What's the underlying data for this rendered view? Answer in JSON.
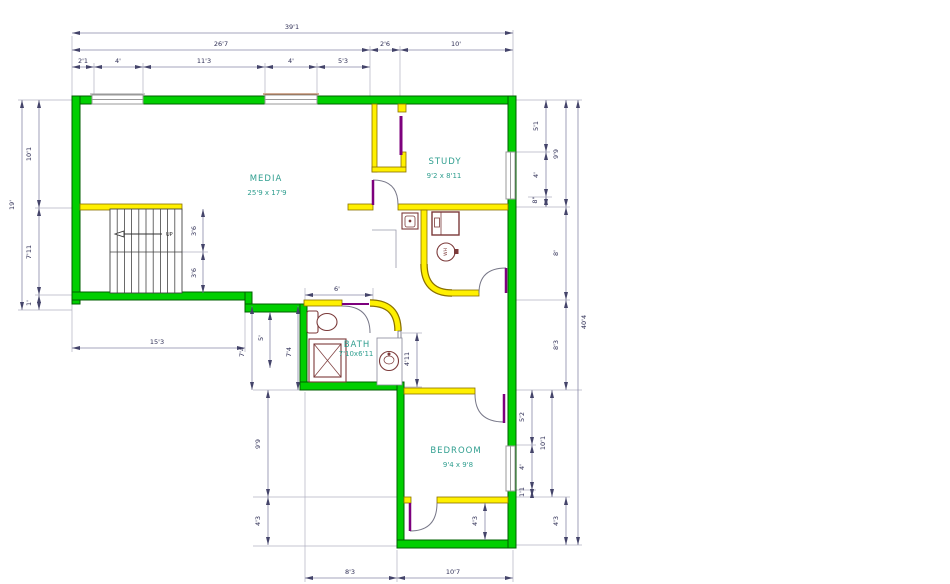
{
  "plan": {
    "type": "floor-plan",
    "stairs": {
      "up_label": "UP"
    },
    "fixtures": {
      "water_heater_label": "WH"
    },
    "colors": {
      "exterior_wall": "#00cf00",
      "interior_wall": "#fff000",
      "door": "#7d007d",
      "fixture_outline": "#7c3a3a",
      "room_text": "#2f9e8f",
      "dimension_text": "#2e2e55",
      "dimension_line": "#8888a8"
    }
  },
  "rooms": [
    {
      "name": "MEDIA",
      "size": "25'9 x 17'9",
      "nx": 266,
      "ny": 181,
      "sx": 267,
      "sy": 195
    },
    {
      "name": "STUDY",
      "size": "9'2 x 8'11",
      "nx": 445,
      "ny": 164,
      "sx": 444,
      "sy": 178
    },
    {
      "name": "BATH",
      "size": "7'10x6'11",
      "nx": 357,
      "ny": 347,
      "sx": 356,
      "sy": 356
    },
    {
      "name": "BEDROOM",
      "size": "9'4 x 9'8",
      "nx": 456,
      "ny": 453,
      "sx": 458,
      "sy": 467
    }
  ],
  "dimensions": [
    {
      "t": "39'1",
      "x1": 72,
      "y1": 33,
      "x2": 513,
      "y2": 33,
      "lx": 292,
      "ly": 29,
      "rot": 0
    },
    {
      "t": "26'7",
      "x1": 72,
      "y1": 50,
      "x2": 370,
      "y2": 50,
      "lx": 221,
      "ly": 46,
      "rot": 0
    },
    {
      "t": "2'6",
      "x1": 370,
      "y1": 50,
      "x2": 400,
      "y2": 50,
      "lx": 385,
      "ly": 46,
      "rot": 0
    },
    {
      "t": "10'",
      "x1": 400,
      "y1": 50,
      "x2": 513,
      "y2": 50,
      "lx": 456,
      "ly": 46,
      "rot": 0
    },
    {
      "t": "2'1",
      "x1": 72,
      "y1": 67,
      "x2": 94,
      "y2": 67,
      "lx": 83,
      "ly": 63,
      "rot": 0
    },
    {
      "t": "4'",
      "x1": 94,
      "y1": 67,
      "x2": 143,
      "y2": 67,
      "lx": 118,
      "ly": 63,
      "rot": 0
    },
    {
      "t": "11'3",
      "x1": 143,
      "y1": 67,
      "x2": 265,
      "y2": 67,
      "lx": 204,
      "ly": 63,
      "rot": 0
    },
    {
      "t": "4'",
      "x1": 265,
      "y1": 67,
      "x2": 317,
      "y2": 67,
      "lx": 291,
      "ly": 63,
      "rot": 0
    },
    {
      "t": "5'3",
      "x1": 317,
      "y1": 67,
      "x2": 370,
      "y2": 67,
      "lx": 343,
      "ly": 63,
      "rot": 0
    },
    {
      "t": "19'",
      "x1": 22,
      "y1": 100,
      "x2": 22,
      "y2": 310,
      "lx": 14,
      "ly": 205,
      "rot": -90
    },
    {
      "t": "10'1",
      "x1": 39,
      "y1": 100,
      "x2": 39,
      "y2": 208,
      "lx": 31,
      "ly": 154,
      "rot": -90
    },
    {
      "t": "7'11",
      "x1": 39,
      "y1": 208,
      "x2": 39,
      "y2": 295,
      "lx": 31,
      "ly": 252,
      "rot": -90
    },
    {
      "t": "1'",
      "x1": 39,
      "y1": 295,
      "x2": 39,
      "y2": 310,
      "lx": 31,
      "ly": 303,
      "rot": -90
    },
    {
      "t": "40'4",
      "x1": 578,
      "y1": 100,
      "x2": 578,
      "y2": 545,
      "lx": 586,
      "ly": 322,
      "rot": -90
    },
    {
      "t": "9'9",
      "x1": 566,
      "y1": 100,
      "x2": 566,
      "y2": 207,
      "lx": 558,
      "ly": 154,
      "rot": -90
    },
    {
      "t": "8'",
      "x1": 566,
      "y1": 207,
      "x2": 566,
      "y2": 300,
      "lx": 558,
      "ly": 253,
      "rot": -90
    },
    {
      "t": "8'3",
      "x1": 566,
      "y1": 300,
      "x2": 566,
      "y2": 390,
      "lx": 558,
      "ly": 345,
      "rot": -90
    },
    {
      "t": "4'3",
      "x1": 566,
      "y1": 497,
      "x2": 566,
      "y2": 545,
      "lx": 558,
      "ly": 521,
      "rot": -90
    },
    {
      "t": "5'1",
      "x1": 546,
      "y1": 100,
      "x2": 546,
      "y2": 152,
      "lx": 538,
      "ly": 126,
      "rot": -90
    },
    {
      "t": "4'",
      "x1": 546,
      "y1": 152,
      "x2": 546,
      "y2": 197,
      "lx": 538,
      "ly": 175,
      "rot": -90
    },
    {
      "t": "8\"",
      "x1": 546,
      "y1": 197,
      "x2": 546,
      "y2": 207,
      "lx": 537,
      "ly": 200,
      "rot": -90
    },
    {
      "t": "10'1",
      "x1": 552,
      "y1": 390,
      "x2": 552,
      "y2": 497,
      "lx": 545,
      "ly": 443,
      "rot": -90
    },
    {
      "t": "5'2",
      "x1": 532,
      "y1": 390,
      "x2": 532,
      "y2": 445,
      "lx": 524,
      "ly": 417,
      "rot": -90
    },
    {
      "t": "4'",
      "x1": 532,
      "y1": 445,
      "x2": 532,
      "y2": 490,
      "lx": 524,
      "ly": 467,
      "rot": -90
    },
    {
      "t": "1'1",
      "x1": 532,
      "y1": 490,
      "x2": 532,
      "y2": 497,
      "lx": 524,
      "ly": 492,
      "rot": -90
    },
    {
      "t": "8'3",
      "x1": 305,
      "y1": 578,
      "x2": 397,
      "y2": 578,
      "lx": 350,
      "ly": 574,
      "rot": 0
    },
    {
      "t": "10'7",
      "x1": 397,
      "y1": 578,
      "x2": 513,
      "y2": 578,
      "lx": 453,
      "ly": 574,
      "rot": 0
    },
    {
      "t": "9'9",
      "x1": 268,
      "y1": 390,
      "x2": 268,
      "y2": 497,
      "lx": 260,
      "ly": 444,
      "rot": -90
    },
    {
      "t": "4'3",
      "x1": 268,
      "y1": 497,
      "x2": 268,
      "y2": 545,
      "lx": 260,
      "ly": 521,
      "rot": -90
    },
    {
      "t": "15'3",
      "x1": 72,
      "y1": 348,
      "x2": 245,
      "y2": 348,
      "lx": 157,
      "ly": 344,
      "rot": 0
    },
    {
      "t": "7'4",
      "x1": 252,
      "y1": 306,
      "x2": 252,
      "y2": 390,
      "lx": 244,
      "ly": 352,
      "rot": -90
    },
    {
      "t": "5'",
      "x1": 270,
      "y1": 312,
      "x2": 270,
      "y2": 368,
      "lx": 263,
      "ly": 338,
      "rot": -90
    },
    {
      "t": "7'4",
      "x1": 298,
      "y1": 306,
      "x2": 298,
      "y2": 390,
      "lx": 291,
      "ly": 352,
      "rot": -90
    },
    {
      "t": "3'6",
      "x1": 203,
      "y1": 209,
      "x2": 203,
      "y2": 252,
      "lx": 196,
      "ly": 231,
      "rot": -90
    },
    {
      "t": "3'6",
      "x1": 203,
      "y1": 252,
      "x2": 203,
      "y2": 293,
      "lx": 196,
      "ly": 273,
      "rot": -90
    },
    {
      "t": "6'",
      "x1": 305,
      "y1": 295,
      "x2": 373,
      "y2": 295,
      "lx": 337,
      "ly": 291,
      "rot": 0
    },
    {
      "t": "4'11",
      "x1": 417,
      "y1": 333,
      "x2": 417,
      "y2": 387,
      "lx": 409,
      "ly": 359,
      "rot": -90
    },
    {
      "t": "4'3",
      "x1": 485,
      "y1": 503,
      "x2": 485,
      "y2": 540,
      "lx": 477,
      "ly": 521,
      "rot": -90
    }
  ]
}
